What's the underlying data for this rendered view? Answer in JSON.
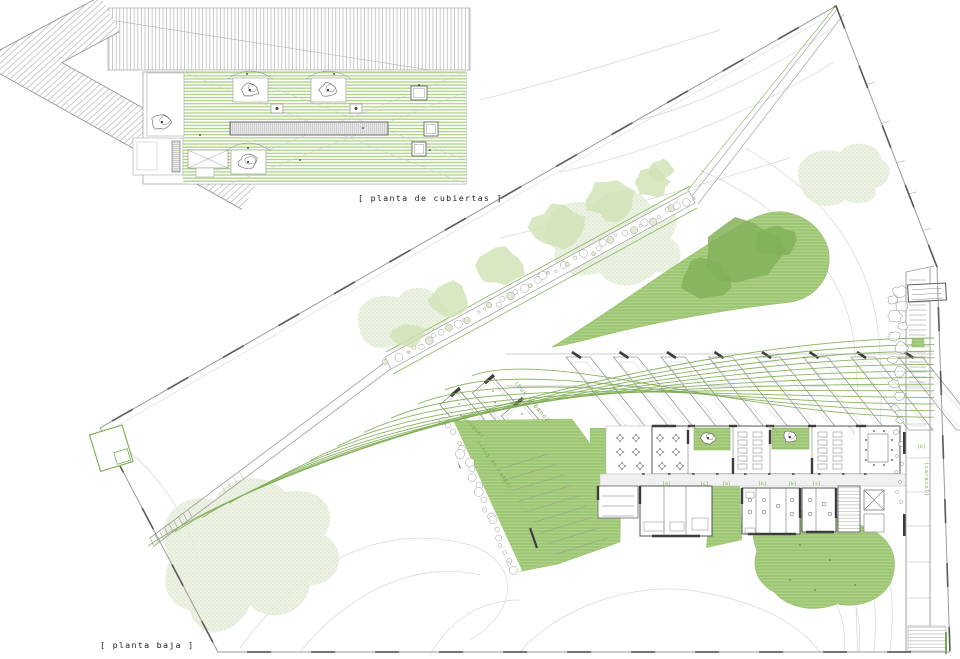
{
  "plan_labels": {
    "roof": "[ planta de cubiertas ]",
    "ground": "[ planta baja ]"
  },
  "site_annotations": {
    "bus_lane": "(bus urbano)",
    "forest": "(bosque)",
    "park": "(casa de campo)",
    "spiral_path": "(caracol)"
  },
  "room_tags": [
    "[e]",
    "[c]",
    "[a]",
    "[b]",
    "[k]",
    "[s]"
  ],
  "colors": {
    "roof_stripe_green": "#a9cf80",
    "lawn_green": "#9dc672",
    "line_green": "#7dac52",
    "label_green": "#79a94e",
    "canopy_green": "#cfe2b4",
    "dark_canopy_green": "#84b259",
    "contour_gray": "#d6d6d6",
    "boundary_gray": "#9a9a9a",
    "wall_dark": "#3d3d3d"
  }
}
